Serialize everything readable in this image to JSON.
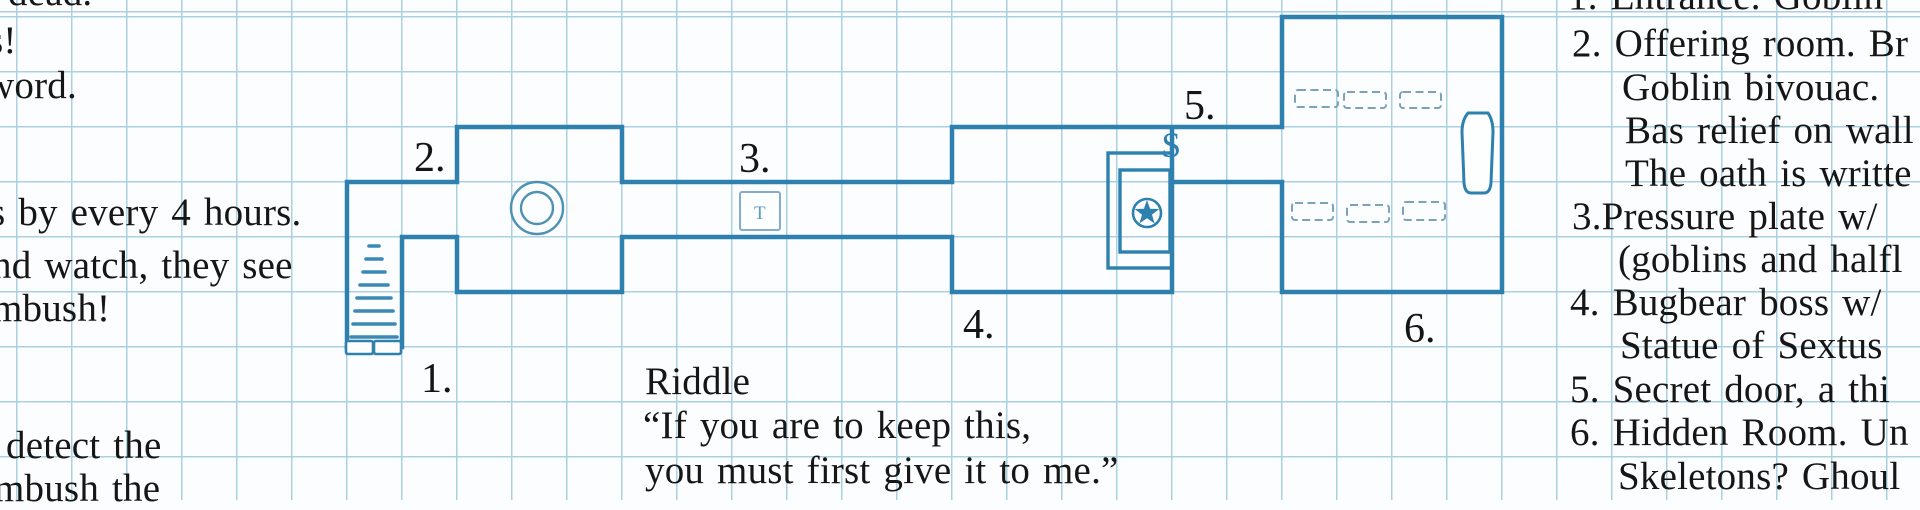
{
  "title": "Hand-drawn dungeon map on graph paper",
  "colors": {
    "wall_blue": "#2e81af",
    "grid_blue": "#abd0e0",
    "ink": "#161616",
    "symbol_blue": "#4f90b5"
  },
  "map": {
    "labels": {
      "room1": "1.",
      "room2": "2.",
      "room3": "3.",
      "room4": "4.",
      "room5": "5.",
      "room6": "6."
    },
    "markers": {
      "secret_door": "$",
      "trap_plate": "T"
    },
    "symbols": [
      "stairs",
      "double-door",
      "well",
      "pressure-plate",
      "statue-star",
      "beds",
      "coffin"
    ]
  },
  "notes_left": {
    "lines": [
      "dead.",
      "s!",
      "word.",
      "s by every 4 hours.",
      "nd watch, they see",
      "mbush!",
      "detect the",
      "mbush the"
    ]
  },
  "riddle": {
    "heading": "Riddle",
    "lines": [
      "“If you are to keep this,",
      "you must first give it to me.”"
    ]
  },
  "notes_right": {
    "lines": [
      "1. Entrance. Goblin",
      "2. Offering room. Br",
      "Goblin bivouac.",
      "Bas relief on wall",
      "The oath is writte",
      "3.Pressure plate w/",
      "(goblins and halfl",
      "4. Bugbear boss w/",
      "Statue of Sextus",
      "5. Secret door, a thi",
      "6. Hidden Room. Un",
      "Skeletons? Ghoul"
    ]
  }
}
